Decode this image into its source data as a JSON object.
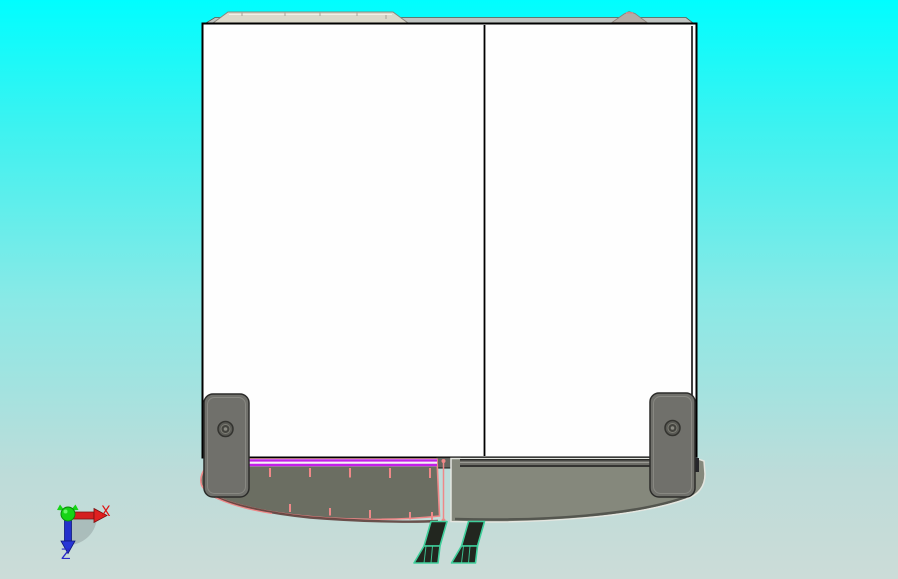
{
  "viewport": {
    "description": "CAD viewport front view of cabinet model with selected base tray",
    "width_px": 898,
    "height_px": 579
  },
  "triad": {
    "x_label": "X",
    "z_label": "Z"
  },
  "model": {
    "parts": [
      "cabinet-front-panel",
      "left-door",
      "right-door",
      "top-lid",
      "top-hinge-cap",
      "left-foot-bracket",
      "right-foot-bracket",
      "base-tray-left-selected",
      "base-tray-right",
      "leveling-foot-left",
      "leveling-foot-right"
    ],
    "selection": "base-tray-left"
  },
  "colors": {
    "bg_top": "#00feff",
    "bg_bottom": "#ccdcd8",
    "cabinet_fill": "#fefefe",
    "cabinet_edge": "#000000",
    "lid_fill": "#dcd9cb",
    "bracket_fill": "#70706b",
    "tray_left_fill": "#6b6e62",
    "tray_right_fill": "#85887c",
    "selection_pink": "#ef8888",
    "selection_magenta": "#c31fe8",
    "tray_shadow": "#5e403c",
    "foot_outline": "#3fcf9b",
    "foot_fill": "#22261f",
    "axis_x": "#de1414",
    "axis_y": "#16d416",
    "axis_z": "#2a2ac8"
  }
}
